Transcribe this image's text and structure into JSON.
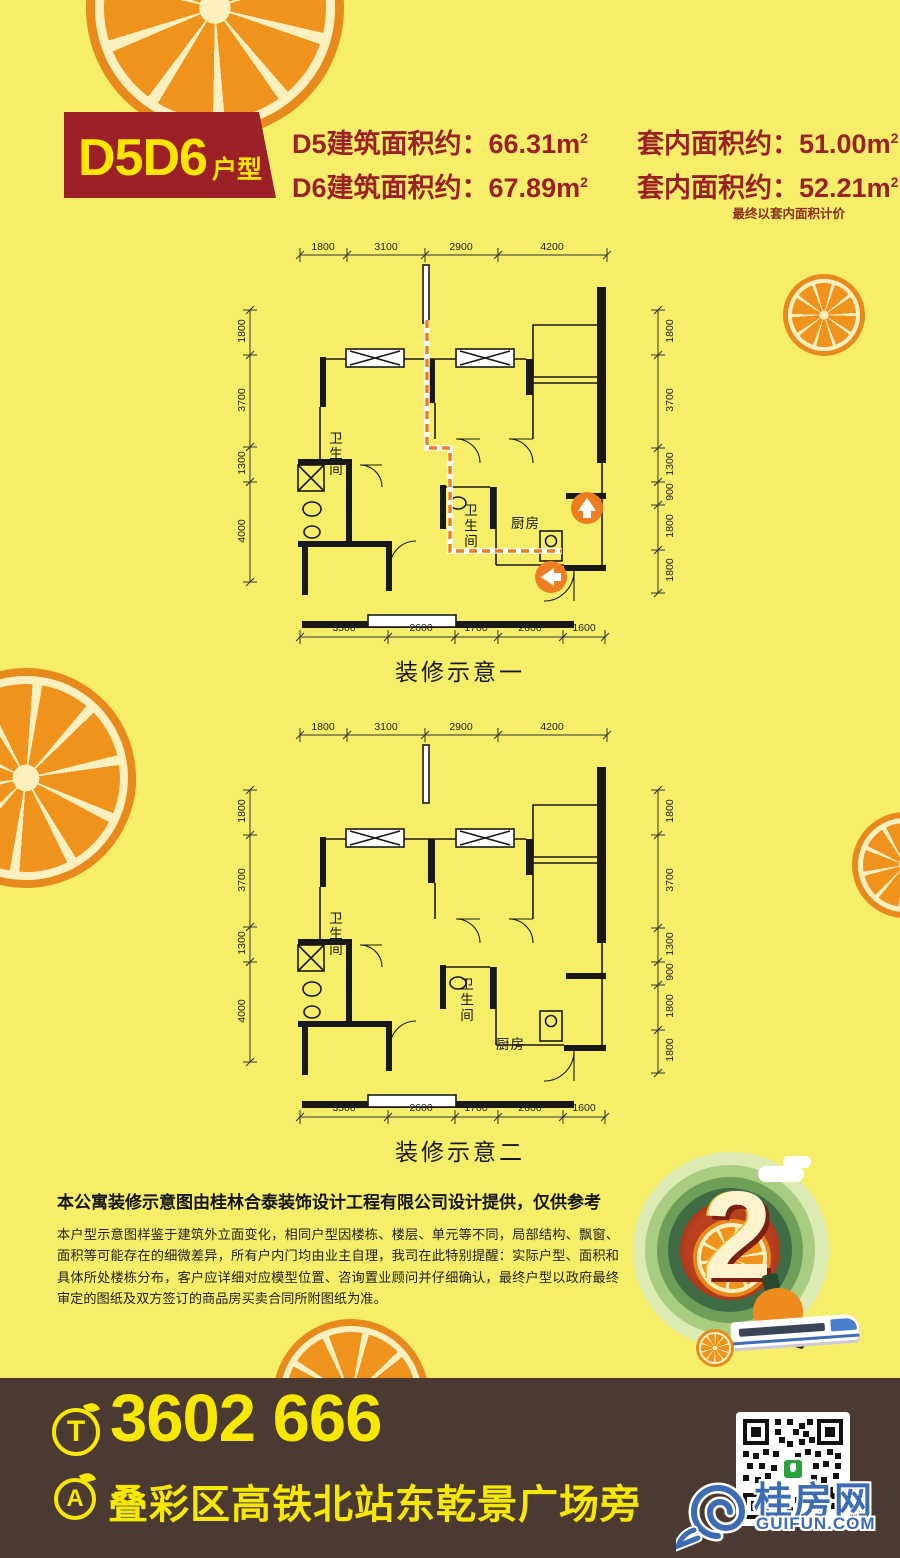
{
  "colors": {
    "background": "#f6ee68",
    "accent_red": "#9b2127",
    "badge_text": "#ffe600",
    "plan_line": "#191919",
    "route_orange": "#ee7d22",
    "footer_bg": "#4b3a32",
    "footer_text": "#f6e800",
    "logo_blue": "#3c6cb4",
    "qr_green": "#2aa23c"
  },
  "header": {
    "badge_title": "D5D6",
    "badge_subtitle": "户型",
    "unit": "m",
    "sup": "2",
    "rows": [
      {
        "build_label": "D5建筑面积约：",
        "build_value": "66.31",
        "inner_label": "套内面积约：",
        "inner_value": "51.00"
      },
      {
        "build_label": "D6建筑面积约：",
        "build_value": "67.89",
        "inner_label": "套内面积约：",
        "inner_value": "52.21"
      }
    ],
    "note": "最终以套内面积计价"
  },
  "plans": [
    {
      "caption": "装修示意一",
      "dims_top": [
        "1800",
        "3100",
        "2900",
        "4200"
      ],
      "dims_bottom": [
        "3500",
        "2600",
        "1700",
        "2600",
        "1600"
      ],
      "dims_left": [
        "1800",
        "3700",
        "1300",
        "4000"
      ],
      "dims_right": [
        "1800",
        "3700",
        "1300",
        "900",
        "1800",
        "1800"
      ],
      "rooms": {
        "bath1": "卫生间",
        "bath2": "卫生间",
        "kitchen": "厨房"
      }
    },
    {
      "caption": "装修示意二",
      "dims_top": [
        "1800",
        "3100",
        "2900",
        "4200"
      ],
      "dims_bottom": [
        "3500",
        "2600",
        "1700",
        "2600",
        "1600"
      ],
      "dims_left": [
        "1800",
        "3700",
        "1300",
        "4000"
      ],
      "dims_right": [
        "1800",
        "3700",
        "1300",
        "900",
        "1800",
        "1800"
      ],
      "rooms": {
        "bath1": "卫生间",
        "bath2": "卫生间",
        "kitchen": "厨房"
      }
    }
  ],
  "disclaimer": {
    "headline": "本公寓装修示意图由桂林合泰装饰设计工程有限公司设计提供，仅供参考",
    "body": "本户型示意图样鉴于建筑外立面变化，相同户型因楼栋、楼层、单元等不同，局部结构、飘窗、面积等可能存在的细微差异，所有户内门均由业主自理，我司在此特别提醒：实际户型、面积和具体所处楼栋分布，客户应详细对应模型位置、咨询置业顾问并仔细确认，最终户型以政府最终审定的图纸及双方签订的商品房买卖合同所附图纸为准。"
  },
  "emblem": {
    "number": "2"
  },
  "footer": {
    "phone_icon": "T",
    "phone": "3602 666",
    "address_icon": "A",
    "address": "叠彩区高铁北站东乾景广场旁",
    "logo_text": "桂房网",
    "logo_domain": "GUIFUN.COM"
  }
}
